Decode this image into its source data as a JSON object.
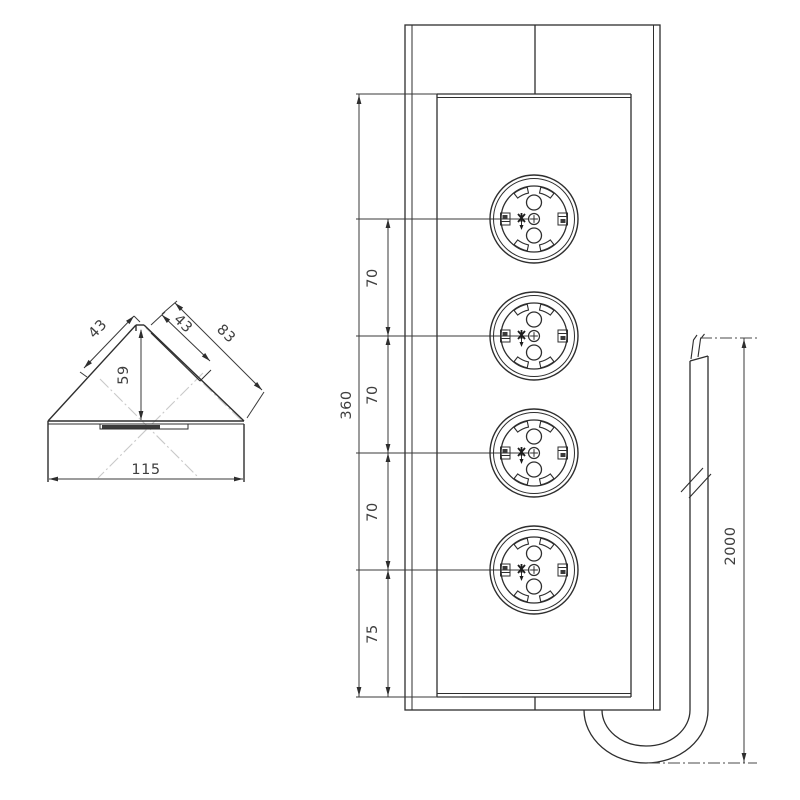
{
  "meta": {
    "type": "technical-drawing",
    "subject": "corner power strip with 4 schuko sockets and cable",
    "views": [
      "corner-profile-section",
      "front-view",
      "cable-run"
    ]
  },
  "colors": {
    "line": "#2e2e2e",
    "dim": "#3f3f3f",
    "centerline": "#c9c9c9",
    "background": "#ffffff"
  },
  "left_view": {
    "dim_slope_upper_left": "43",
    "dim_height": "59",
    "dim_face_width": "43",
    "dim_slope_right": "83",
    "dim_base_width": "115"
  },
  "front_view": {
    "socket_count": 4,
    "dim_total_height": "360",
    "dim_pitch_1": "70",
    "dim_pitch_2": "70",
    "dim_pitch_3": "70",
    "dim_bottom_offset": "75"
  },
  "cable": {
    "dim_length": "2000"
  }
}
